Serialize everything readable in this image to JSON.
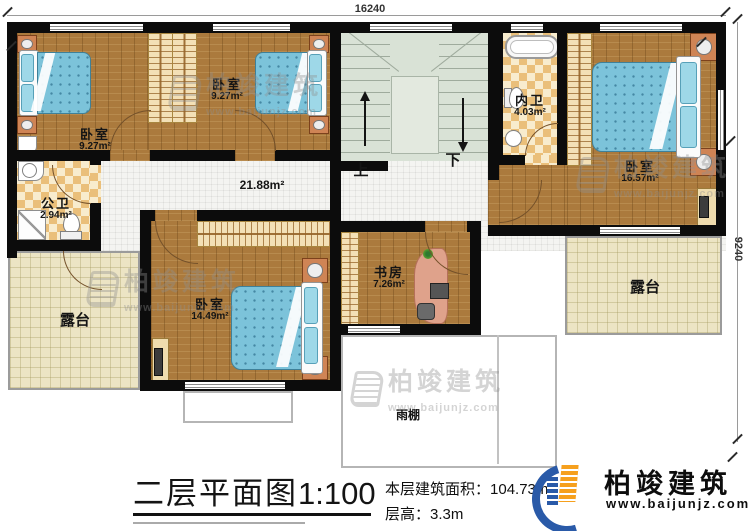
{
  "dims": {
    "top": "16240",
    "right": "9240"
  },
  "rooms": {
    "bedroom_top_left": {
      "name": "卧室",
      "area": "9.27m²"
    },
    "bedroom_top_center": {
      "name": "卧室",
      "area": "9.27m²"
    },
    "bedroom_right": {
      "name": "卧室",
      "area": "16.57m²"
    },
    "bedroom_bottom": {
      "name": "卧室",
      "area": "14.49m²"
    },
    "public_bath": {
      "name": "公卫",
      "area": "2.94m²"
    },
    "inner_bath": {
      "name": "内卫",
      "area": "4.03m²"
    },
    "study": {
      "name": "书房",
      "area": "7.26m²"
    },
    "hallway": {
      "area": "21.88m²"
    },
    "terrace_left": {
      "name": "露台"
    },
    "terrace_right": {
      "name": "露台"
    },
    "canopy": {
      "name": "雨棚"
    },
    "stairs": {
      "up": "上",
      "down": "下"
    }
  },
  "footer": {
    "title": "二层平面图",
    "scale": "1:100",
    "area_label": "本层建筑面积：",
    "area_value": "104.73m²",
    "height_label": "层高：",
    "height_value": "3.3m"
  },
  "brand": {
    "name": "柏竣建筑",
    "site": "www.baijunjz.com"
  },
  "watermark": {
    "name": "柏竣建筑",
    "site": "www.baijunjz.com"
  }
}
